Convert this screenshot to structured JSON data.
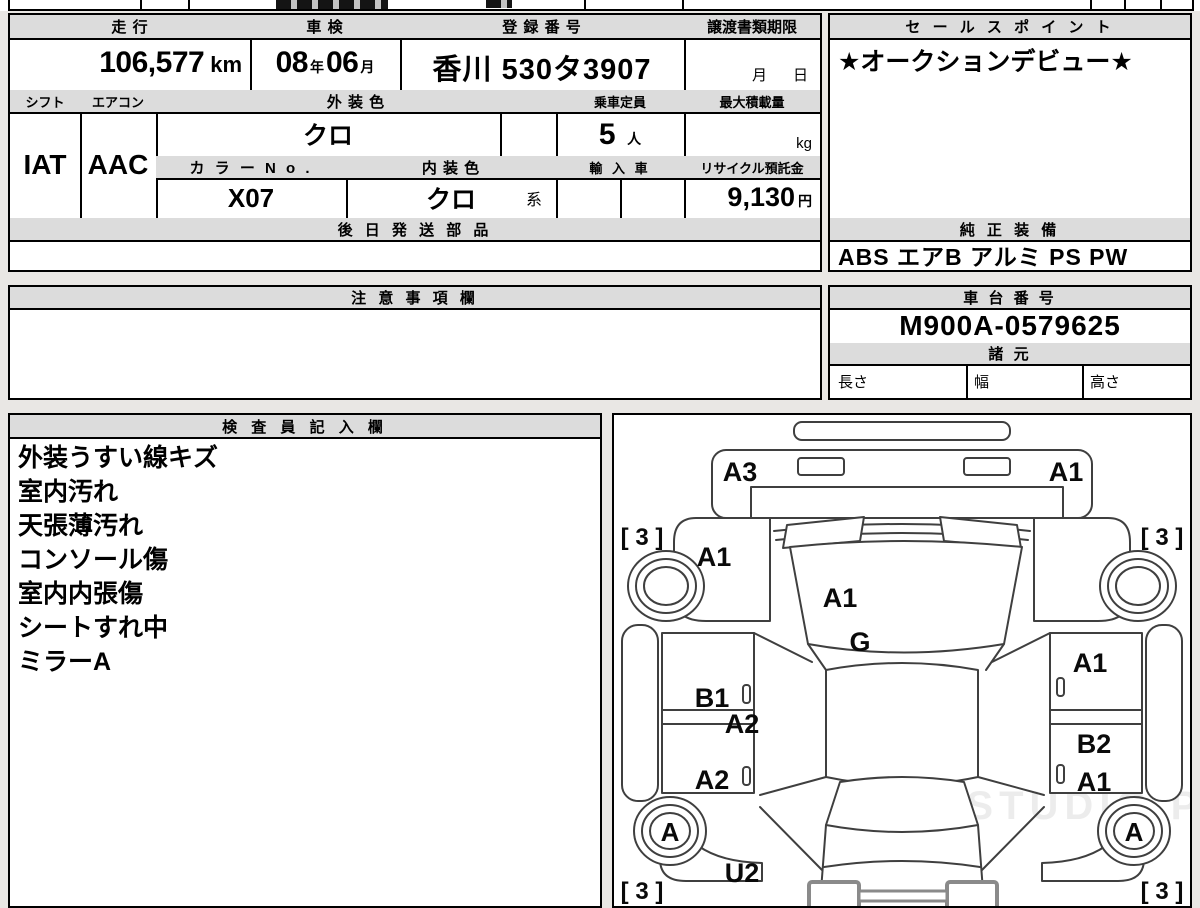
{
  "info": {
    "headers": {
      "mileage": "走 行",
      "inspection": "車 検",
      "registration": "登 録 番 号",
      "transfer": "譲渡書類期限",
      "shift": "シフト",
      "aircon": "エアコン",
      "exterior_color": "外 装 色",
      "capacity": "乗車定員",
      "max_load": "最大積載量",
      "color_no": "カ ラ ー N o .",
      "interior_color": "内 装 色",
      "import": "輸 入 車",
      "recycle_deposit": "リサイクル預託金",
      "later_shipped_parts": "後 日 発 送 部 品"
    },
    "values": {
      "mileage": "106,577",
      "mileage_unit": "km",
      "inspection_year": "08",
      "year_suffix": "年",
      "inspection_month": "06",
      "month_suffix": "月",
      "registration": "香川 530タ3907",
      "transfer_month": "月",
      "transfer_day": "日",
      "shift": "IAT",
      "aircon": "AAC",
      "exterior_color": "クロ",
      "capacity": "5",
      "capacity_unit": "人",
      "max_load_unit": "kg",
      "color_no": "X07",
      "interior_color": "クロ",
      "interior_color_suffix": "系",
      "recycle_deposit": "9,130",
      "recycle_unit": "円"
    }
  },
  "sales_point": {
    "header": "セ ー ル ス ポ イ ン ト",
    "value": "★オークションデビュー★"
  },
  "equipment": {
    "header": "純 正 装 備",
    "value": "ABS エアB アルミ PS PW"
  },
  "notes": {
    "header": "注 意 事 項 欄"
  },
  "chassis": {
    "header": "車 台 番 号",
    "number": "M900A-0579625",
    "specs_header": "諸 元",
    "length_label": "長さ",
    "width_label": "幅",
    "height_label": "高さ"
  },
  "inspector": {
    "header": "検 査 員 記 入 欄",
    "lines": [
      "外装うすい線キズ",
      "室内汚れ",
      "天張薄汚れ",
      "コンソール傷",
      "室内内張傷",
      "シートすれ中",
      "ミラーA"
    ]
  },
  "diagram": {
    "watermark": "WEB STUDIO.PRO",
    "labels": {
      "front_left_panel": "A3",
      "front_right_panel": "A1",
      "tire_front_left": "[ 3 ]",
      "tire_front_right": "[ 3 ]",
      "left_front_fender": "A1",
      "hood": "A1",
      "glass": "G",
      "left_front_door": "B1",
      "left_door_mid": "A2",
      "left_rear_door": "A2",
      "right_front_door": "A1",
      "right_rear_door": "B2",
      "right_rear_quarter": "A1",
      "rear_wheel_left": "A",
      "rear_wheel_right": "A",
      "left_rear_fender": "U2",
      "tire_rear_left": "[ 3 ]",
      "tire_rear_right": "[ 3 ]"
    }
  }
}
